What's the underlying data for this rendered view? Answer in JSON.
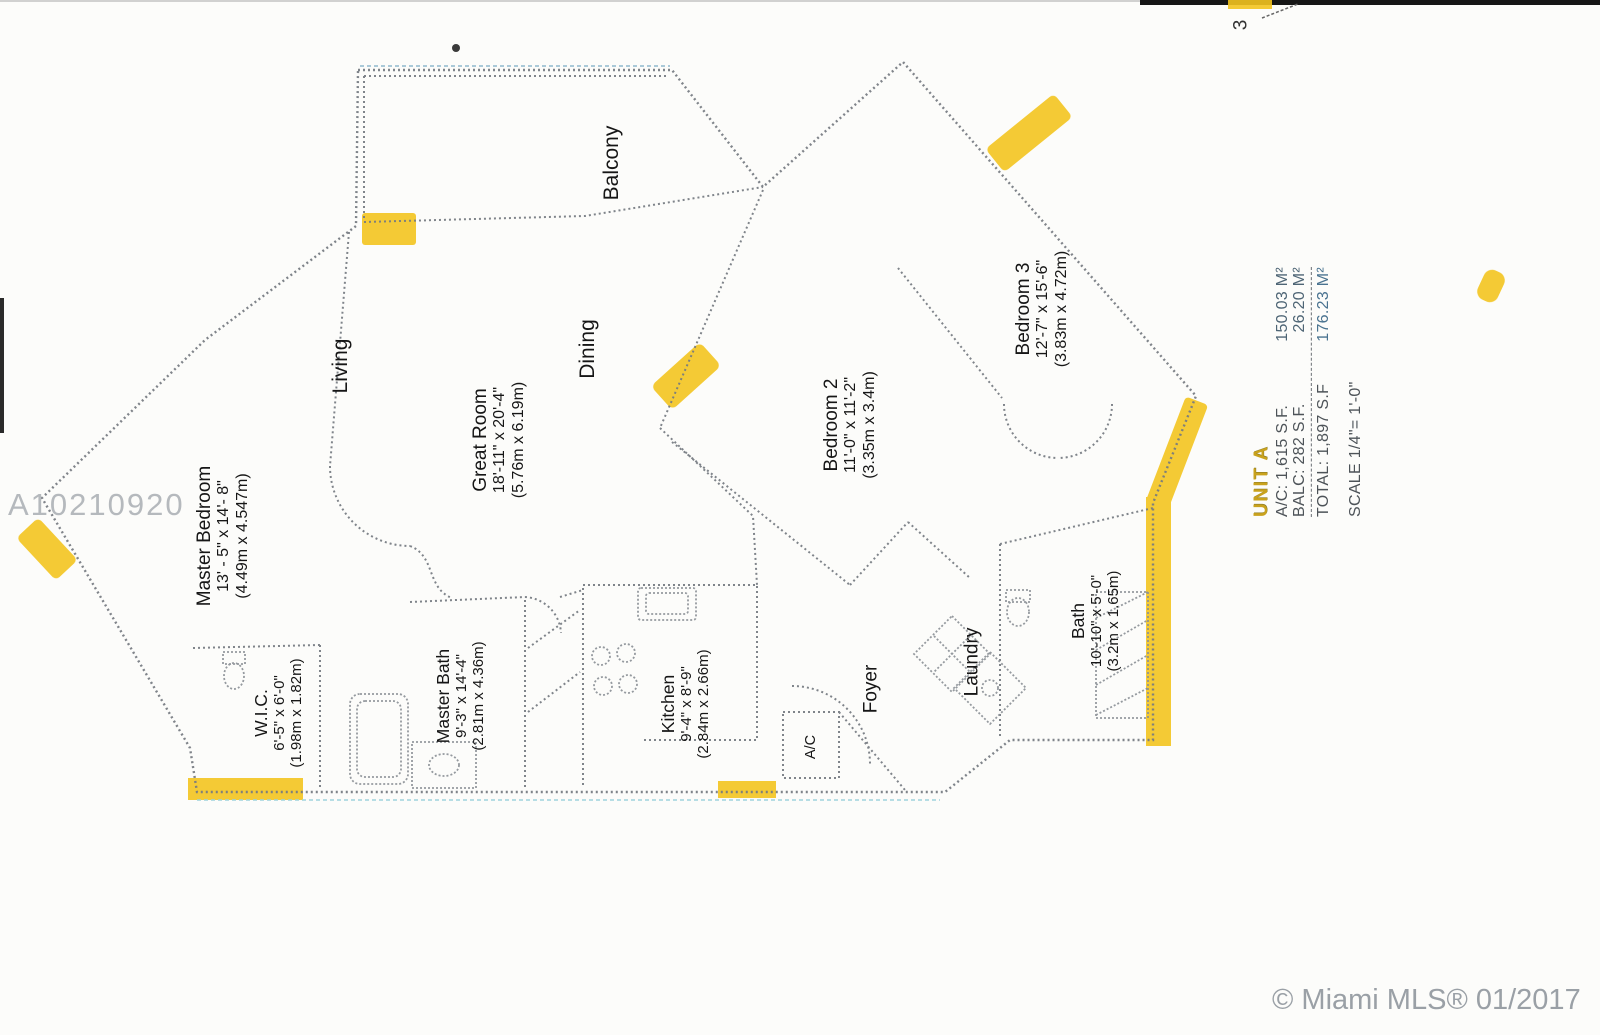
{
  "colors": {
    "highlight": "#f3c51f",
    "unit_text": "#c9a21d",
    "wall": "#757a80",
    "watermark": "#b5b9bd",
    "copyright": "#9aa0a6"
  },
  "watermark": "A10210920",
  "page_artifacts": {
    "corner_digit": "3"
  },
  "copyright": "© Miami MLS® 01/2017",
  "info_panel": {
    "unit": "UNIT A",
    "ac_line": "A/C: 1,615 S.F.",
    "ac_m2": "150.03 M²",
    "balc_line": "BALC: 282 S.F.",
    "balc_m2": "26.20 M²",
    "total_line": "TOTAL: 1,897 S.F",
    "total_m2": "176.23 M²",
    "scale_line": "SCALE 1/4\"= 1'-0\""
  },
  "rooms": [
    {
      "name": "Balcony",
      "dims": "",
      "metric": ""
    },
    {
      "name": "Living",
      "dims": "",
      "metric": ""
    },
    {
      "name": "Dining",
      "dims": "",
      "metric": ""
    },
    {
      "name": "Great Room",
      "dims": "18'-11\" x 20'-4\"",
      "metric": "(5.76m x 6.19m)"
    },
    {
      "name": "Master Bedroom",
      "dims": "13' - 5\" x 14'- 8\"",
      "metric": "(4.49m x 4.547m)"
    },
    {
      "name": "W.I.C.",
      "dims": "6'-5\" x 6'-0\"",
      "metric": "(1.98m x 1.82m)"
    },
    {
      "name": "Master Bath",
      "dims": "9'-3\" x 14'-4\"",
      "metric": "(2.81m x 4.36m)"
    },
    {
      "name": "Kitchen",
      "dims": "9'-4\" x 8'-9\"",
      "metric": "(2.84m x 2.66m)"
    },
    {
      "name": "A/C",
      "dims": "",
      "metric": ""
    },
    {
      "name": "Foyer",
      "dims": "",
      "metric": ""
    },
    {
      "name": "Laundry",
      "dims": "",
      "metric": ""
    },
    {
      "name": "Bath",
      "dims": "10'-10\" x 5'-0\"",
      "metric": "(3.2m x 1.65m)"
    },
    {
      "name": "Bedroom 2",
      "dims": "11'-0\" x 11'-2\"",
      "metric": "(3.35m x 3.4m)"
    },
    {
      "name": "Bedroom 3",
      "dims": "12'-7\" x 15'-6\"",
      "metric": "(3.83m x 4.72m)"
    }
  ]
}
